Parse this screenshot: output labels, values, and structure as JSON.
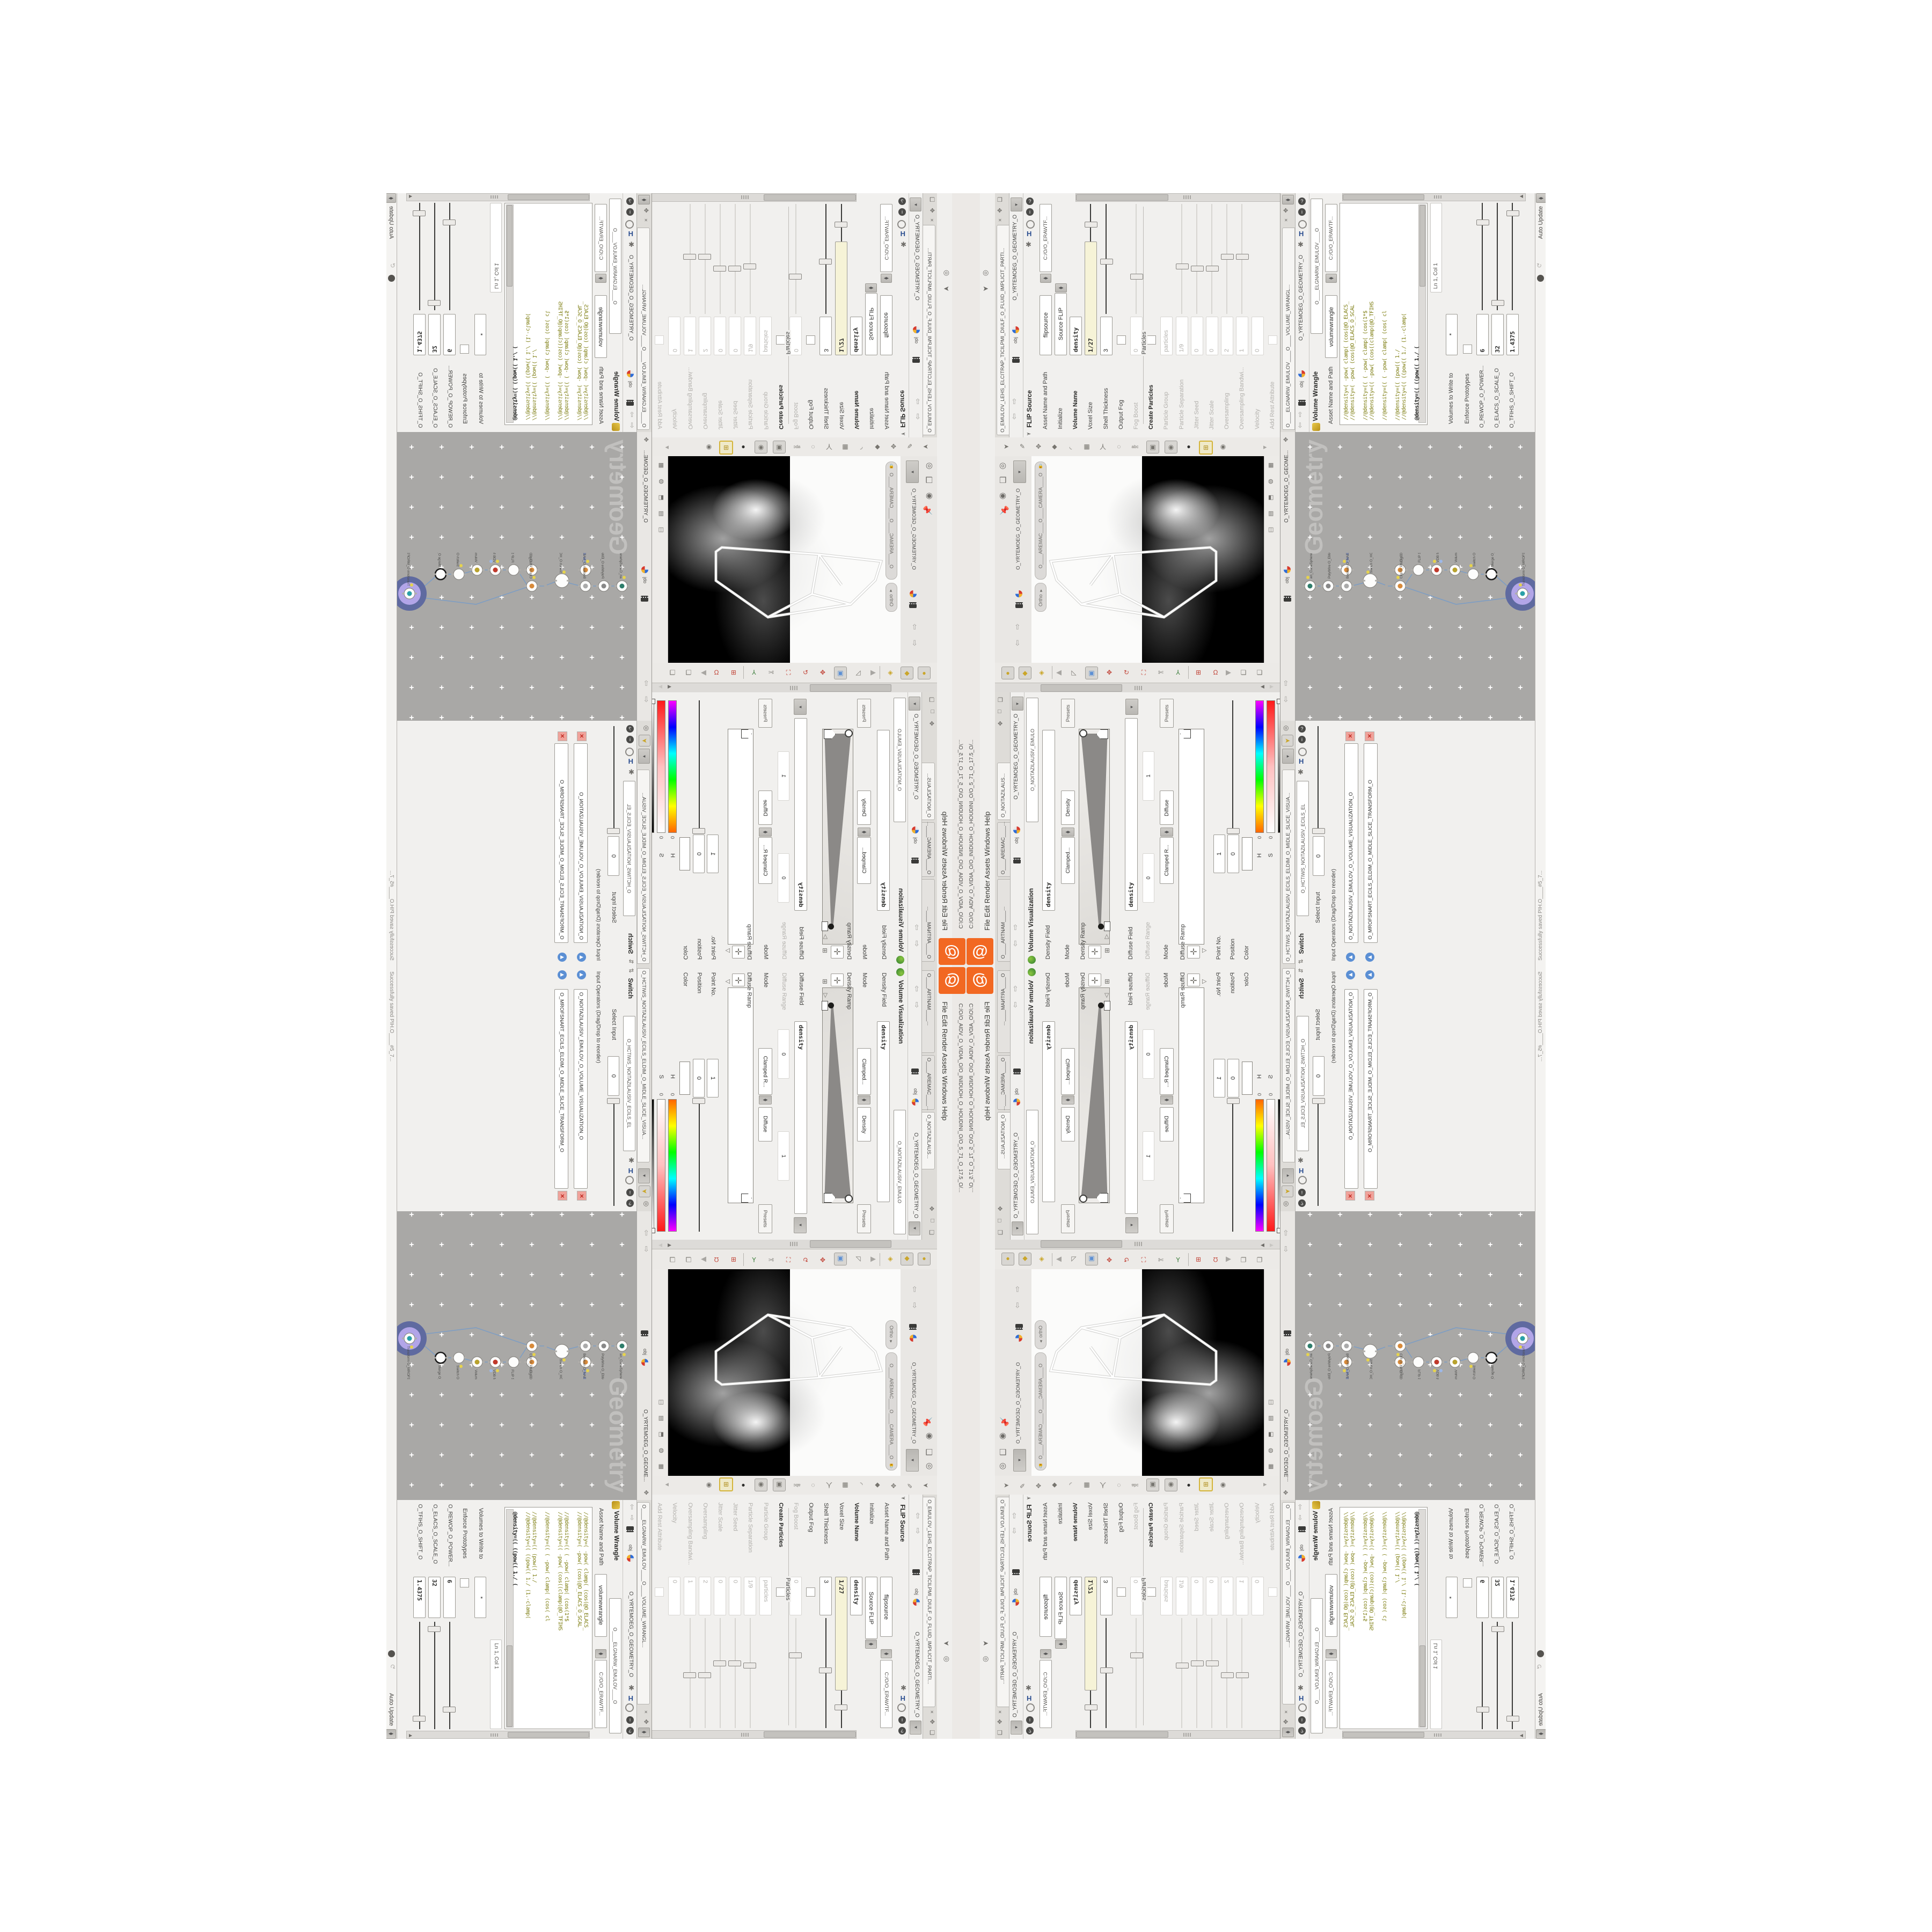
{
  "window": {
    "title": "C:/O/O_AIDV_O_VIDIA_O/O_INIDUOH_O_HOUDINI_O/O_5_71_O_17.5_O/...",
    "menus": [
      "File",
      "Edit",
      "Render",
      "Assets",
      "Windows",
      "Help"
    ],
    "auto_update": "Auto Update",
    "status_saved": "Successfully saved PIH.O____#5_7...",
    "logo": "houdini-logo"
  },
  "colors": {
    "accent_orange": "#f26822",
    "pane_bg": "#f1f0ee",
    "network_bg": "#a9a8a6",
    "selected_node": "#b2a5e8",
    "selected_ring": "#5f6aa0",
    "wire_blue": "#7d9dc4",
    "code_olive": "#7f7f14",
    "code_teal": "#1e8fa0",
    "expression_field": "#f6f3d7",
    "flag_yellow": "#e6d34d"
  },
  "breadcrumb": {
    "root": "obj",
    "path": "O_YRTEMOEG_O_GEOMETRY_O"
  },
  "flip": {
    "tab": "O_EMULOV_LEHS_ELCITRAP_TICILPMI_DIULF_O_FLUID_IMPLICIT_PARTI...",
    "title": "FLIP Source",
    "title_tab": "O_EMULOV_LEHS_ELCITRAP_TICI",
    "asset_label": "Asset Name and Path",
    "asset_name": "flipsource",
    "asset_path": "C:/O/O_ERAWTF...",
    "particles_section": "Particles",
    "rows": [
      {
        "label": "Initialize",
        "value": "Source FLIP",
        "type": "dropdown"
      },
      {
        "label": "Volume Name",
        "value": "density",
        "type": "field",
        "bold": true
      },
      {
        "label": "Voxel Size",
        "value": "1/27",
        "type": "cream",
        "slider": "dark",
        "handle": 0.18
      },
      {
        "label": "Shell Thickness",
        "value": "3",
        "type": "field",
        "slider": "dark",
        "handle": 0.55
      },
      {
        "label": "Output Fog",
        "value": "",
        "type": "check"
      },
      {
        "label": "Fog Boost",
        "value": "0",
        "type": "field",
        "gray": true,
        "slider": "faint",
        "handle": 0.7
      },
      {
        "label": "Create Particles",
        "value": "",
        "type": "check",
        "bold": true
      },
      {
        "label": "Particle Group",
        "value": "particles",
        "type": "field",
        "gray": true
      },
      {
        "label": "Particle Separation",
        "value": "1/9",
        "type": "field",
        "gray": true,
        "slider": "faint",
        "handle": 0.6
      },
      {
        "label": "Jitter Seed",
        "value": "0",
        "type": "field",
        "gray": true,
        "slider": "faint",
        "handle": 0.62
      },
      {
        "label": "Jitter Scale",
        "value": "0",
        "type": "field",
        "gray": true,
        "slider": "faint",
        "handle": 0.62
      },
      {
        "label": "Oversampling",
        "value": "2",
        "type": "field",
        "gray": true,
        "slider": "faint",
        "handle": 0.5
      },
      {
        "label": "Oversampling Bandwi...",
        "value": "1",
        "type": "field",
        "gray": true,
        "slider": "faint",
        "handle": 0.5
      },
      {
        "label": "Velocity",
        "value": "0",
        "type": "field",
        "gray": true
      },
      {
        "label": "Add Rest Attribute",
        "value": "",
        "type": "check",
        "gray": true
      }
    ]
  },
  "wrangle": {
    "tab": "O____ELGNARW_EMULOV____O____VOLUME_WRANGL...",
    "title": "Volume Wrangle",
    "title_tab": "O____ELGNARW_EMULOV____O",
    "asset_label": "Asset Name and Path",
    "asset_name": "volumewrangle",
    "asset_path": "C:/O/O_ERAWTF...",
    "code": [
      "//@density=(   -pow(  clamp(  (cos(@O_ELACS_",
      "//@density=(   -pow(     (cos(@O_ELACS_O_SCAL",
      "",
      "//@density=((  (  -pow(  clamp(  (cos(1*$",
      "//@density=((  -pow(    (cos((clamp(@O_TFIHS",
      "",
      "//@density=((  (  -pow(  clamp(  (cos( cl",
      "",
      "//@density=((     (pow((     1./",
      "//@density=((  ((pow((  1./ (1.-clamp(",
      "",
      "@density=((  ((pow((  1./ ("
    ],
    "cursor_pos": "Ln 1, Col 1",
    "volumes_label": "Volumes to Write to",
    "volumes_value": "*",
    "enforce_label": "Enforce Prototypes",
    "params": [
      {
        "label": "O_REWOP_O_POWER...",
        "value": "6",
        "handle": 0.16
      },
      {
        "label": "O_ELACS_O_SCALE_O",
        "value": "32",
        "handle": 0.93
      },
      {
        "label": "O_TFIHS_O_SHIFT_O",
        "value": "1.4375",
        "handle": 0.07
      }
    ]
  },
  "viewport": {
    "camera_pill": "O____AREMAC____O____CAMERA____O",
    "ortho_pill": "Ortho ▾",
    "pane_tab": "O_YRTEMOEG_O_GEOMETRY_O"
  },
  "network": {
    "watermark": "Geometry",
    "breadcrumb": "O_YRTEMOEG_O_GEOME...",
    "nodes": [
      {
        "type": "an_CubeSphere",
        "name": "O_EREHPS_EBUC_O"
      },
      {
        "type": "PolyWire",
        "name": "O_EMARFERIW_NOGYLOP_O"
      },
      {
        "type": "File",
        "name": "JBO.M3_PETS_THGILS_O"
      },
      {
        "type": "Boolean",
        "name": "O_NAELOOB_O"
      },
      {
        "type": "Switch",
        "name": "O_HCTIWS_YRTEMOEG_O"
      },
      {
        "type": "Clip",
        "name": "O_EMULOV_PILC_O"
      },
      {
        "type": "Clip",
        "name": "O_PILC_O"
      },
      {
        "type": "FLIP Source",
        "name": "O_EMULOV_PILF_O"
      },
      {
        "type": "VDB from Polygons",
        "name": "O_SNOGYLOP_BDV_O"
      },
      {
        "type": "Volume Rasterize",
        "name": "O_EZIRETSAR_O"
      },
      {
        "type": "Switch",
        "name": "O_HCTIWS_LANRETNI_O"
      },
      {
        "type": "Merge",
        "name": "O_EGREM_O"
      },
      {
        "type": "Transform",
        "name": "O_MROFSNART_ECILS_ELDIM_O"
      }
    ]
  },
  "viz": {
    "tabs": [
      "O_NOITAZILAUS...",
      "O____AREMAC____...",
      "O____ARTNAM____..."
    ],
    "title": "Volume Visualization",
    "title_tab": "O_NOITAZILAUSIV_EMULO",
    "density_field_label": "Density Field",
    "density_field_value": "density",
    "mode_label": "Mode",
    "mode1_value": "Clamped...",
    "mode1_extra": "Density",
    "presets": "Presets",
    "density_ramp_label": "Density Ramp",
    "diffuse_field_label": "Diffuse Field",
    "diffuse_field_value": "density",
    "diffuse_range_label": "Diffuse Range",
    "diffuse_range_v0": "0",
    "diffuse_range_v1": "1",
    "mode2_value": "Clamped R...",
    "mode2_extra": "Diffuse",
    "diffuse_ramp_label": "Diffuse Ramp",
    "point_label": "Point No.",
    "point_value": "1",
    "position_label": "Position",
    "position_value": "0",
    "color_label": "Color",
    "h_label": "H",
    "h_value": "0",
    "s_label": "S",
    "s_value": "0",
    "v_label": "V",
    "v_value": "1.8125",
    "interp_label": "Interpolation",
    "interp_value": "Linear"
  },
  "switch_pane": {
    "tab": "O_HCTIWS_NOITAZILAUSIV_ECILS_ELDIM_O_MIDLE_SLICE_VISUA...",
    "title": "Switch",
    "title_tab": "O_HCTIWS_NOITAZILAUSIV_ECILS_EL",
    "select_label": "Select Input",
    "select_value": "0",
    "operators_label": "Input Operators (Drag/Drop to reorder)",
    "items": [
      "O_NOITAZILAUSIV_EMULOV_O_VOLUME_VISUALIZATION_O",
      "O_MROFSNART_ECILS_ELDIM_O_MIDLE_SLICE_TRANSFORM_O"
    ]
  }
}
